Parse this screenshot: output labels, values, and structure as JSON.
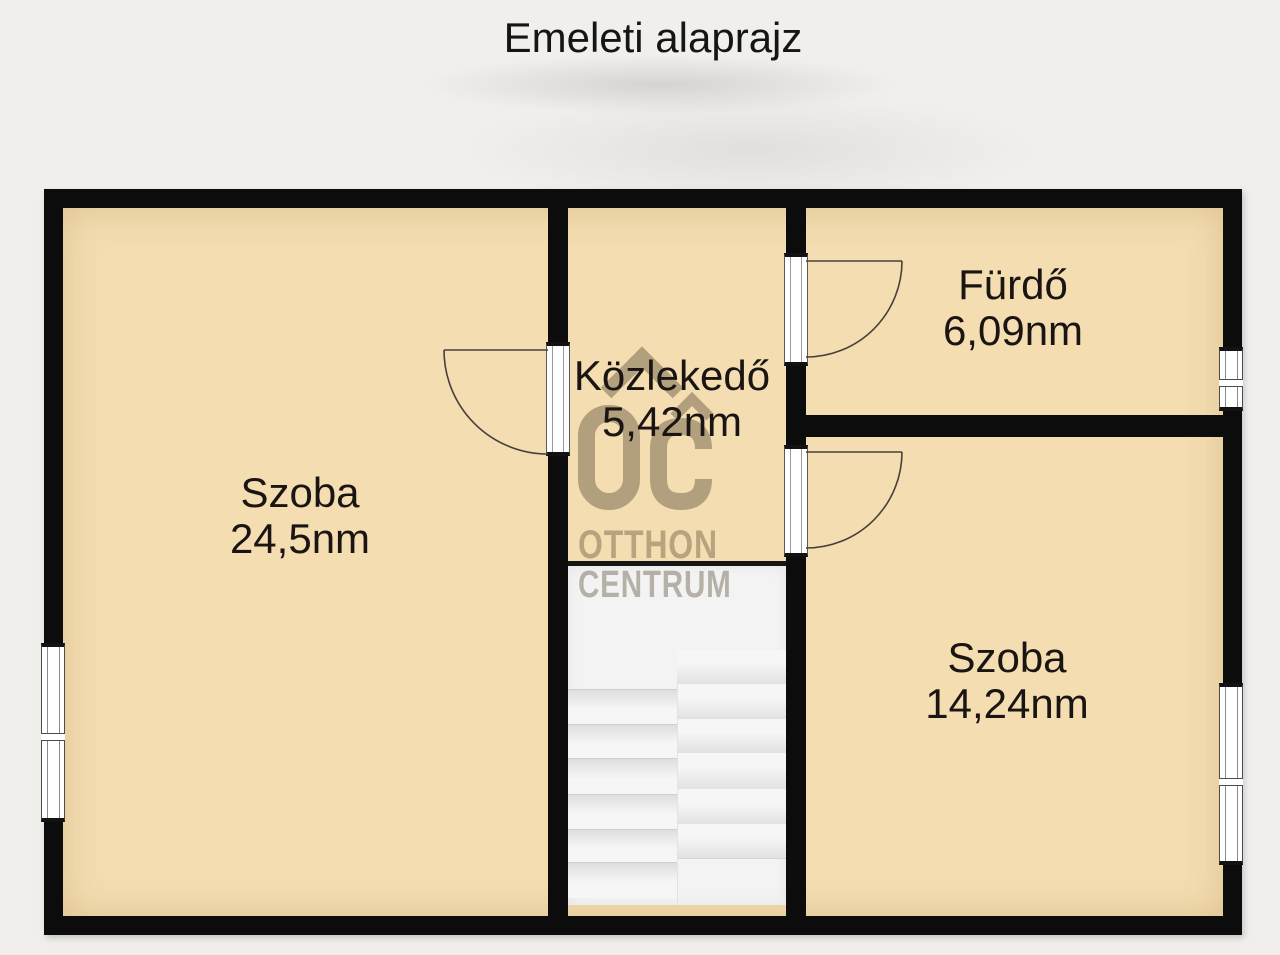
{
  "title": "Emeleti alaprajz",
  "rooms": [
    {
      "name": "Szoba",
      "area": "24,5nm"
    },
    {
      "name": "Közlekedő",
      "area": "5,42nm"
    },
    {
      "name": "Fürdő",
      "area": "6,09nm"
    },
    {
      "name": "Szoba",
      "area": "14,24nm"
    }
  ],
  "watermark": {
    "logo": "OC",
    "line1": "OTTHON",
    "line2": "CENTRUM"
  },
  "colors": {
    "background": "#f1efec",
    "room_fill": "#f3ddb1",
    "wall": "#0c0c0c",
    "stairs": "#f3f3f3",
    "watermark": "rgba(97,85,62,0.42)"
  }
}
